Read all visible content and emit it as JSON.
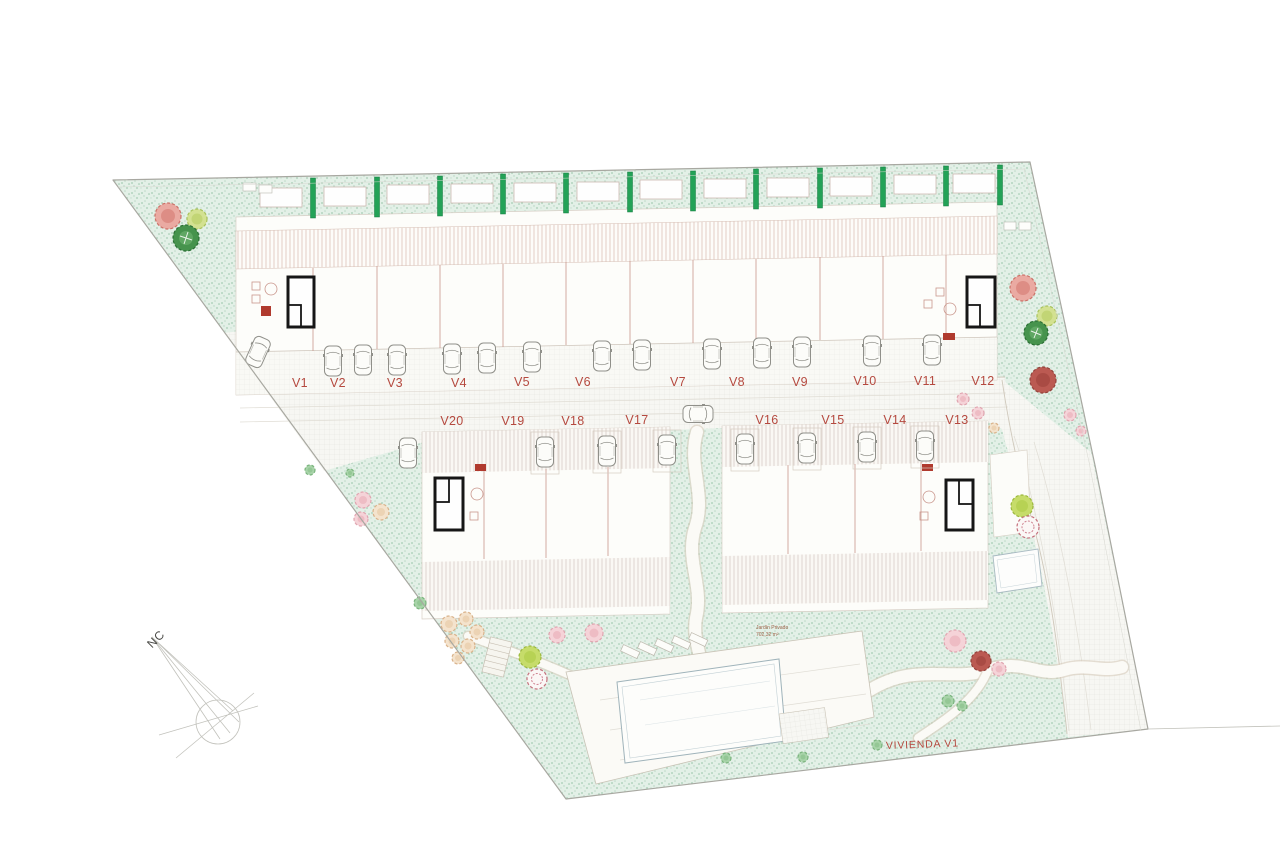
{
  "plan": {
    "compass_label": "NC",
    "site_annotation": "VIVIENDA V1",
    "garden_area_label": {
      "line1": "Jardín Privado",
      "line2": "702,32 m²"
    },
    "top_row_units": [
      {
        "label": "V1"
      },
      {
        "label": "V2"
      },
      {
        "label": "V3"
      },
      {
        "label": "V4"
      },
      {
        "label": "V5"
      },
      {
        "label": "V6"
      },
      {
        "label": "V7"
      },
      {
        "label": "V8"
      },
      {
        "label": "V9"
      },
      {
        "label": "V10"
      },
      {
        "label": "V11"
      },
      {
        "label": "V12"
      }
    ],
    "bottom_row_units": [
      {
        "label": "V20"
      },
      {
        "label": "V19"
      },
      {
        "label": "V18"
      },
      {
        "label": "V17"
      },
      {
        "label": "V16"
      },
      {
        "label": "V15"
      },
      {
        "label": "V14"
      },
      {
        "label": "V13"
      }
    ]
  },
  "colors": {
    "label_red": "#b5493f",
    "accent_red": "#b03a2e",
    "hedge_green": "#23a257",
    "lawn_mint": "#e3f0e7",
    "boundary_gray": "#a8a8a1"
  }
}
